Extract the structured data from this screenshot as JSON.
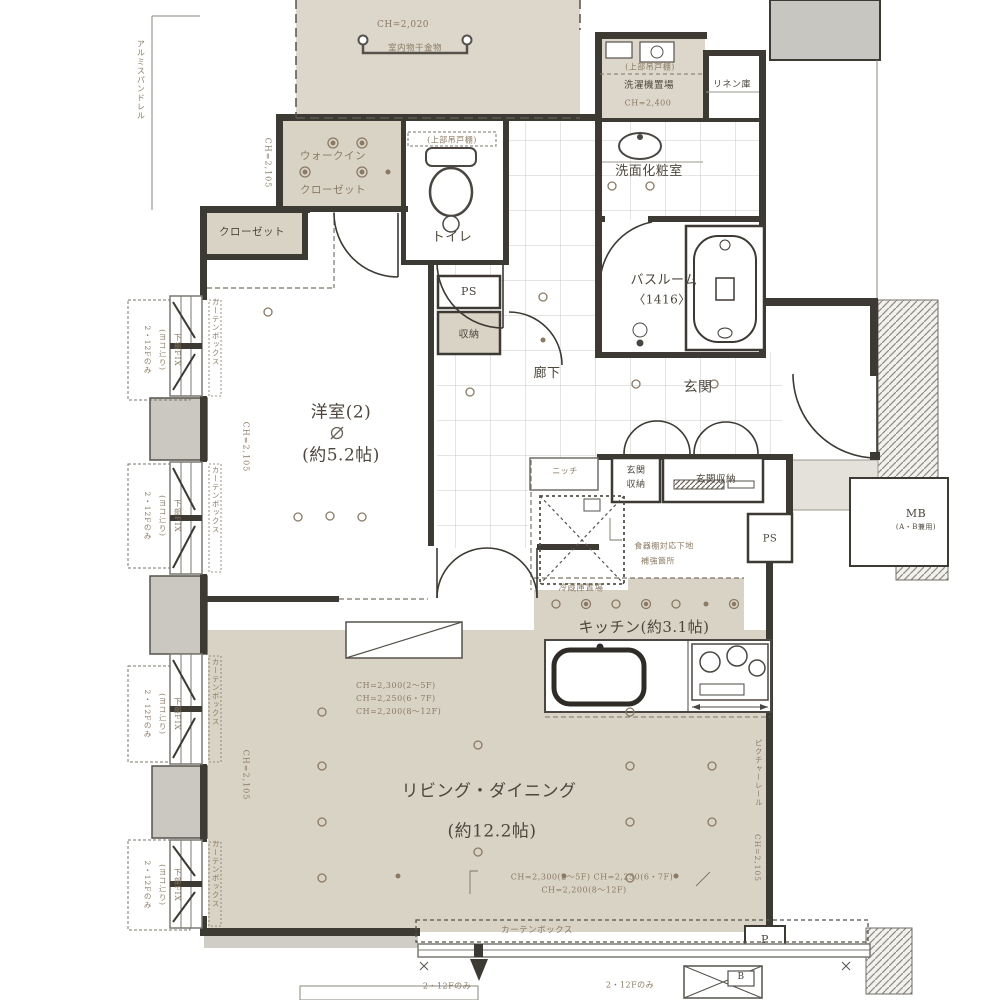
{
  "rooms": {
    "western": "洋室(2)",
    "western_size": "(約5.2帖)",
    "living": "リビング・ダイニング",
    "living_size": "(約12.2帖)",
    "kitchen": "キッチン(約3.1帖)",
    "fridge": "冷蔵庫置場",
    "bathroom": "バスルーム",
    "bathroom_size": "〈1416〉",
    "washroom": "洗面化粧室",
    "toilet": "トイレ",
    "entrance": "玄関",
    "corridor": "廊下",
    "wic_line1": "ウォークイン",
    "wic_line2": "クローゼット",
    "closet": "クローゼット",
    "linen": "リネン庫",
    "laundry": "洗濯機置場",
    "storage": "収納",
    "niche": "ニッチ",
    "shoe_cabinet_1_line1": "玄関",
    "shoe_cabinet_1_line2": "収納",
    "shoe_cabinet_2": "玄関収納"
  },
  "annotations": {
    "ch_balcony": "CH=2,020",
    "indoor_drying": "室内物干金物",
    "spandrel": "アルミスパンドレル",
    "ch_wic": "CH=2,105",
    "ch_western": "CH=2,105",
    "ch_living_left": "CH=2,105",
    "ch_living_right": "CH=2,105",
    "picture_rail": "ピクチャーレール",
    "upper_shelf_toilet": "(上部吊戸棚)",
    "upper_shelf_laundry": "(上部吊戸棚)",
    "ch_laundry": "CH=2,400",
    "cupboard_l1": "食器棚対応下地",
    "cupboard_l2": "補強箇所",
    "ch_lines": [
      "CH=2,300(2〜5F)",
      "CH=2,250(6・7F)",
      "CH=2,200(8〜12F)"
    ],
    "ch_bottom_l1": "CH=2,300(2〜5F) CH=2,250(6・7F)",
    "ch_bottom_l2": "CH=2,200(8〜12F)",
    "curtain_box": "カーテンボックス",
    "curtain_box_side": "カーテンボックス",
    "floors_only": "2・12Fのみ",
    "window_note_l1": "下部FIX",
    "window_note_l2": "(ヨコ辷り)",
    "window_note_l3": "2・12Fのみ",
    "ps": "PS",
    "mb": "MB",
    "mb_sub": "(A・B兼用)",
    "p_mark": "P",
    "b_mark": "B"
  },
  "colors": {
    "floor_beige": "#d9d3c6",
    "balcony_beige": "#ddd7cb",
    "wall_dark": "#3d3933",
    "annotation_brown": "#8b7a63",
    "label_dark": "#4c463c",
    "tile_grid": "#c9c9c9",
    "concrete_gray": "#c8c6c0"
  }
}
